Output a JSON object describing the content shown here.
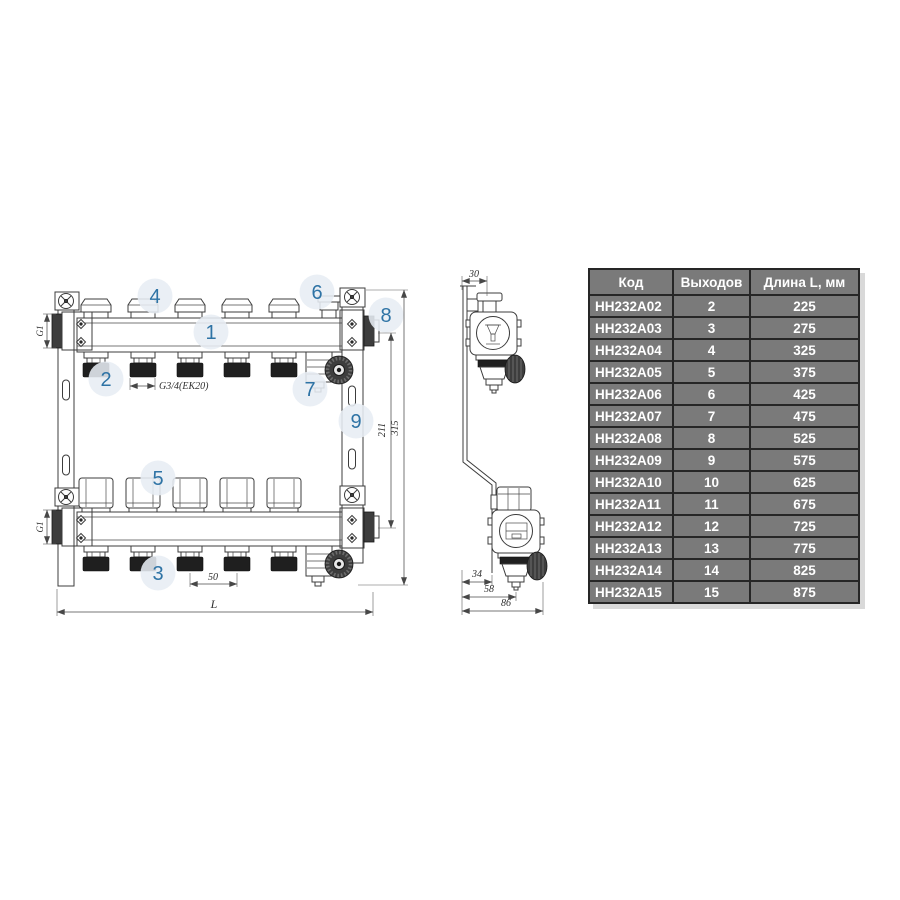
{
  "drawing": {
    "callouts": [
      {
        "label": "1"
      },
      {
        "label": "2"
      },
      {
        "label": "3"
      },
      {
        "label": "4"
      },
      {
        "label": "5"
      },
      {
        "label": "6"
      },
      {
        "label": "7"
      },
      {
        "label": "8"
      },
      {
        "label": "9"
      }
    ],
    "dimensions": {
      "g1_top": "G1",
      "g1_bottom": "G1",
      "outlet_thread": "G3/4(EK20)",
      "outlet_spacing": "50",
      "length": "L",
      "height_axes": "211",
      "height_total": "315",
      "side_top_depth": "30",
      "side_dim_34": "34",
      "side_dim_58": "58",
      "side_dim_86": "86"
    }
  },
  "table": {
    "columns": [
      "Код",
      "Выходов",
      "Длина L, мм"
    ],
    "rows": [
      [
        "НН232А02",
        "2",
        "225"
      ],
      [
        "НН232А03",
        "3",
        "275"
      ],
      [
        "НН232А04",
        "4",
        "325"
      ],
      [
        "НН232А05",
        "5",
        "375"
      ],
      [
        "НН232А06",
        "6",
        "425"
      ],
      [
        "НН232А07",
        "7",
        "475"
      ],
      [
        "НН232А08",
        "8",
        "525"
      ],
      [
        "НН232А09",
        "9",
        "575"
      ],
      [
        "НН232А10",
        "10",
        "625"
      ],
      [
        "НН232А11",
        "11",
        "675"
      ],
      [
        "НН232А12",
        "12",
        "725"
      ],
      [
        "НН232А13",
        "13",
        "775"
      ],
      [
        "НН232А14",
        "14",
        "825"
      ],
      [
        "НН232А15",
        "15",
        "875"
      ]
    ]
  },
  "colors": {
    "table_bg": "#7a7a7a",
    "table_border": "#262626",
    "table_text": "#ffffff",
    "callout_bg": "#e7edf4",
    "callout_text": "#2e73a5",
    "line": "#3c3c3c"
  }
}
